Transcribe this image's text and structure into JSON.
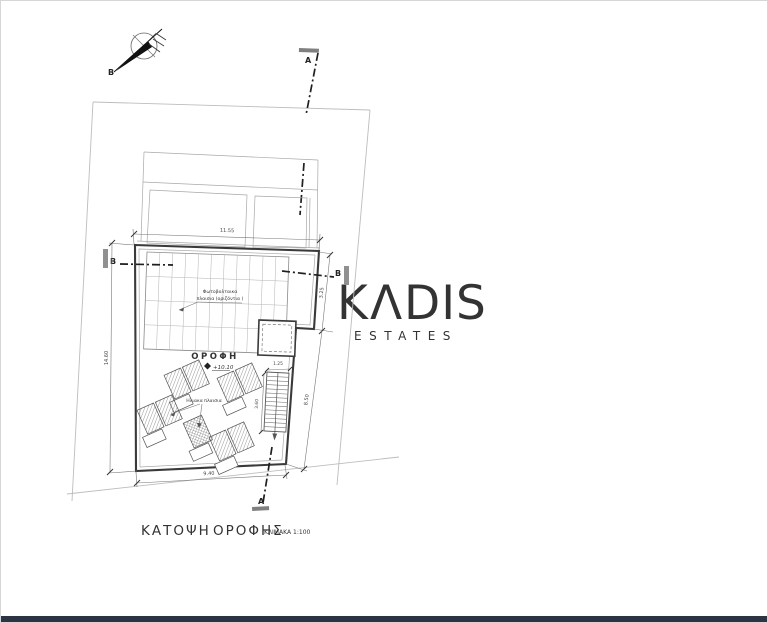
{
  "title": {
    "word1": "ΚΑΤΟΨΗ",
    "word2": "ΟΡΟΦΗΣ",
    "scale": "ΚΛΙΜΑΚΑ 1:100"
  },
  "watermark": {
    "prefix": "K",
    "accent": "Λ",
    "suffix": "DIS",
    "subtitle": "ESTATES",
    "accent_color": "#b9ac8e",
    "gray_color": "#c9c9c9"
  },
  "north": {
    "label": "B"
  },
  "sections": {
    "a_top": "A",
    "a_bottom": "A",
    "b_left": "B",
    "b_right": "B"
  },
  "dimensions": {
    "top": "11.55",
    "left": "14.60",
    "right_upper": "3.25",
    "right_lower": "8.50",
    "bottom": "9.40",
    "stair_width": "1.25",
    "stair_run": "3.60"
  },
  "labels": {
    "pv_line1": "Φωτοβολταικα",
    "pv_line2": "πλαισια (οριζόντια )",
    "solar_panels": "Ηλιακα πλαισια",
    "roof": "ΟΡΟΦΗ",
    "roof_level": "+10.10"
  },
  "colors": {
    "footer_bar": "#2b3442"
  }
}
